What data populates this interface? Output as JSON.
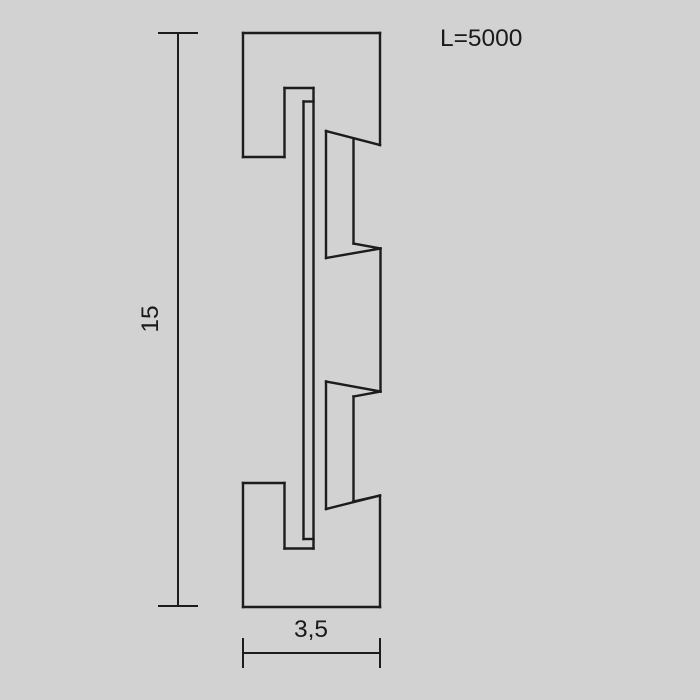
{
  "drawing": {
    "background_color": "#d2d2d2",
    "line_color": "#1c1c1c",
    "profile_stroke_width": 2.4,
    "dimension_stroke_width": 2,
    "length_label": "L=5000",
    "height_dimension": {
      "label": "15",
      "line": [
        178,
        33,
        178,
        606
      ],
      "caps": [
        [
          158,
          33,
          198,
          33
        ],
        [
          158,
          606,
          198,
          606
        ]
      ]
    },
    "width_dimension": {
      "label": "3,5",
      "line": [
        243,
        653,
        380,
        653
      ],
      "caps": [
        [
          243,
          638,
          243,
          668
        ],
        [
          380,
          638,
          380,
          668
        ]
      ]
    },
    "profile_segments": [
      [
        243,
        33,
        380,
        33
      ],
      [
        380,
        33,
        380,
        145
      ],
      [
        243,
        33,
        243,
        157
      ],
      [
        243,
        157,
        284.5,
        157
      ],
      [
        284.5,
        157,
        284.5,
        88
      ],
      [
        284.5,
        88,
        313.5,
        88
      ],
      [
        313.5,
        88,
        313.5,
        548.5
      ],
      [
        313.5,
        101.5,
        303.5,
        101.5
      ],
      [
        303.5,
        101.5,
        303.5,
        539
      ],
      [
        303.5,
        539,
        313.5,
        539
      ],
      [
        313.5,
        548.5,
        284.5,
        548.5
      ],
      [
        284.5,
        548.5,
        284.5,
        483
      ],
      [
        284.5,
        483,
        243,
        483
      ],
      [
        243,
        483,
        243,
        607
      ],
      [
        243,
        607,
        380,
        607
      ],
      [
        380,
        607,
        380,
        495.5
      ],
      [
        326,
        131,
        380,
        145
      ],
      [
        326,
        131,
        326,
        258
      ],
      [
        353.5,
        138.5,
        353.5,
        243.5
      ],
      [
        326,
        258,
        380.5,
        248.5
      ],
      [
        353.5,
        243.5,
        380.5,
        248.5
      ],
      [
        380.5,
        248.5,
        380.5,
        391.5
      ],
      [
        326,
        381.5,
        380.5,
        391.5
      ],
      [
        353.5,
        396.5,
        380.5,
        391.5
      ],
      [
        326,
        381.5,
        326,
        509
      ],
      [
        353.5,
        396.5,
        353.5,
        501.5
      ],
      [
        326,
        509,
        380,
        495.5
      ],
      [
        353.5,
        501.5,
        380,
        495.5
      ]
    ]
  }
}
